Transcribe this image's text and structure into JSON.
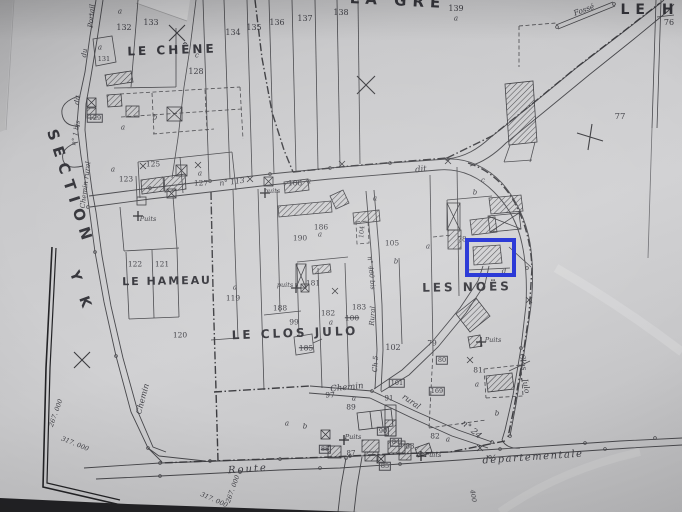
{
  "colors": {
    "ink": "#47474b",
    "paper": "#c9c9cb",
    "highlight_blue": "#1b2bd4",
    "sheet_edge_black": "#232326"
  },
  "highlight": {
    "name": "highlighted-parcel-box",
    "x": 465,
    "y": 238,
    "w": 43,
    "h": 31,
    "border": 4,
    "color": "#1b2bd4"
  },
  "labels": [
    {
      "t": "LA   GRE",
      "x": 398,
      "y": 1,
      "r": 3,
      "fs": 15,
      "b": 1,
      "ls": 6,
      "name": "place-name-la-gre"
    },
    {
      "t": "LE  H",
      "x": 650,
      "y": 10,
      "r": 0,
      "fs": 14,
      "b": 1,
      "ls": 6,
      "name": "place-name-le-h"
    },
    {
      "t": "LE CHÊNE",
      "x": 172,
      "y": 50,
      "r": -2,
      "fs": 12,
      "b": 1,
      "ls": 3,
      "name": "place-name-le-chene"
    },
    {
      "t": "LE HAMEAU",
      "x": 167,
      "y": 281,
      "r": -1,
      "fs": 11,
      "b": 1,
      "ls": 2,
      "name": "place-name-le-hameau"
    },
    {
      "t": "LE CLOS JULO",
      "x": 295,
      "y": 333,
      "r": -2,
      "fs": 12,
      "b": 1,
      "ls": 3,
      "name": "place-name-le-clos-julo"
    },
    {
      "t": "LES NOËS",
      "x": 467,
      "y": 287,
      "r": -1,
      "fs": 12,
      "b": 1,
      "ls": 3,
      "name": "place-name-les-noes"
    },
    {
      "t": "SECTION",
      "x": 70,
      "y": 188,
      "r": 72,
      "fs": 15,
      "b": 1,
      "ls": 7,
      "name": "section-label"
    },
    {
      "t": "Y K",
      "x": 81,
      "y": 292,
      "r": 70,
      "fs": 14,
      "b": 1,
      "ls": 6,
      "name": "section-code"
    },
    {
      "t": "Portail",
      "x": 92,
      "y": 16,
      "r": -85,
      "fs": 7,
      "i": 1,
      "name": "road-name"
    },
    {
      "t": "du",
      "x": 85,
      "y": 53,
      "r": -83,
      "fs": 7,
      "i": 1,
      "name": "road-name"
    },
    {
      "t": "dit",
      "x": 78,
      "y": 100,
      "r": -80,
      "fs": 7,
      "i": 1,
      "name": "road-name"
    },
    {
      "t": "n° 1 bis",
      "x": 76,
      "y": 133,
      "r": -80,
      "fs": 6.5,
      "i": 1,
      "name": "road-name"
    },
    {
      "t": "Chemin rural",
      "x": 86,
      "y": 185,
      "r": -83,
      "fs": 7,
      "i": 1,
      "name": "road-name"
    },
    {
      "t": "n° 113",
      "x": 232,
      "y": 182,
      "r": -7,
      "fs": 7.5,
      "i": 1,
      "name": "road-name"
    },
    {
      "t": "dit",
      "x": 421,
      "y": 170,
      "r": -6,
      "fs": 8.5,
      "i": 1,
      "name": "road-name"
    },
    {
      "t": "Chemin",
      "x": 143,
      "y": 399,
      "r": -75,
      "fs": 8,
      "i": 1,
      "name": "road-name"
    },
    {
      "t": "Route",
      "x": 248,
      "y": 470,
      "r": -4,
      "fs": 10,
      "i": 1,
      "ls": 2,
      "name": "road-name-route"
    },
    {
      "t": "départementale",
      "x": 533,
      "y": 458,
      "r": -4,
      "fs": 10,
      "i": 1,
      "ls": 1.5,
      "name": "road-name-departementale"
    },
    {
      "t": "Chemin",
      "x": 347,
      "y": 388,
      "r": -6,
      "fs": 8.5,
      "i": 1,
      "name": "road-name"
    },
    {
      "t": "rural",
      "x": 411,
      "y": 402,
      "r": 35,
      "fs": 8,
      "i": 1,
      "name": "road-name"
    },
    {
      "t": "n° 24",
      "x": 471,
      "y": 430,
      "r": 40,
      "fs": 8.5,
      "i": 1,
      "name": "road-name"
    },
    {
      "t": "n° 460 bis",
      "x": 371,
      "y": 273,
      "r": 84,
      "fs": 6.5,
      "i": 1,
      "name": "road-name"
    },
    {
      "t": "Rural",
      "x": 373,
      "y": 316,
      "r": -86,
      "fs": 7,
      "i": 1,
      "name": "road-name"
    },
    {
      "t": "Ch 5",
      "x": 376,
      "y": 364,
      "r": -86,
      "fs": 7,
      "i": 1,
      "name": "road-name"
    },
    {
      "t": "Clos",
      "x": 523,
      "y": 362,
      "r": 80,
      "fs": 7.5,
      "i": 1,
      "name": "road-name-clos-julo"
    },
    {
      "t": "Julo",
      "x": 526,
      "y": 386,
      "r": 80,
      "fs": 7.5,
      "i": 1,
      "name": "road-name-clos-julo"
    },
    {
      "t": "Fossé",
      "x": 584,
      "y": 10,
      "r": -20,
      "fs": 7.5,
      "i": 1,
      "name": "fosse-label"
    },
    {
      "t": "Puits",
      "x": 148,
      "y": 219,
      "fs": 6.5,
      "i": 1,
      "name": "well-label"
    },
    {
      "t": "puits",
      "x": 272,
      "y": 191,
      "fs": 6.5,
      "i": 1,
      "name": "well-label"
    },
    {
      "t": "puits",
      "x": 285,
      "y": 285,
      "fs": 6.5,
      "i": 1,
      "name": "well-label"
    },
    {
      "t": "Puits",
      "x": 493,
      "y": 340,
      "fs": 6.5,
      "i": 1,
      "name": "well-label"
    },
    {
      "t": "Puits",
      "x": 353,
      "y": 437,
      "fs": 6.5,
      "i": 1,
      "name": "well-label"
    },
    {
      "t": "Puits",
      "x": 433,
      "y": 455,
      "fs": 6.5,
      "i": 1,
      "name": "well-label"
    },
    {
      "t": "267. 000",
      "x": 56,
      "y": 413,
      "r": -70,
      "fs": 6.5,
      "i": 1,
      "name": "grid-coordinate"
    },
    {
      "t": "317. 000",
      "x": 75,
      "y": 444,
      "r": 22,
      "fs": 6.5,
      "i": 1,
      "name": "grid-coordinate"
    },
    {
      "t": "317. 000",
      "x": 214,
      "y": 500,
      "r": 24,
      "fs": 6.5,
      "i": 1,
      "name": "grid-coordinate"
    },
    {
      "t": "267. 000",
      "x": 233,
      "y": 489,
      "r": -70,
      "fs": 6.5,
      "i": 1,
      "name": "grid-coordinate"
    },
    {
      "t": "400",
      "x": 473,
      "y": 496,
      "r": 80,
      "fs": 6.5,
      "i": 1,
      "name": "grid-coordinate"
    },
    {
      "t": "a",
      "x": 120,
      "y": 12,
      "fs": 7,
      "i": 1
    },
    {
      "t": "132",
      "x": 124,
      "y": 28,
      "fs": 8
    },
    {
      "t": "133",
      "x": 151,
      "y": 23,
      "fs": 8
    },
    {
      "t": "134",
      "x": 233,
      "y": 33,
      "fs": 8
    },
    {
      "t": "135",
      "x": 254,
      "y": 28,
      "fs": 8
    },
    {
      "t": "136",
      "x": 277,
      "y": 23,
      "fs": 8
    },
    {
      "t": "137",
      "x": 305,
      "y": 19,
      "fs": 8
    },
    {
      "t": "138",
      "x": 341,
      "y": 13,
      "fs": 8
    },
    {
      "t": "139",
      "x": 456,
      "y": 9,
      "fs": 8
    },
    {
      "t": "a",
      "x": 456,
      "y": 19,
      "fs": 7,
      "i": 1
    },
    {
      "t": "76",
      "x": 669,
      "y": 23,
      "fs": 8
    },
    {
      "t": "77",
      "x": 620,
      "y": 117,
      "fs": 8.5
    },
    {
      "t": "a",
      "x": 100,
      "y": 48,
      "fs": 7,
      "i": 1
    },
    {
      "t": "131",
      "x": 104,
      "y": 59,
      "fs": 6.5
    },
    {
      "t": "c",
      "x": 197,
      "y": 56,
      "fs": 7,
      "i": 1
    },
    {
      "t": "128",
      "x": 196,
      "y": 72,
      "fs": 8
    },
    {
      "t": "b",
      "x": 155,
      "y": 118,
      "fs": 7,
      "i": 1
    },
    {
      "t": "a",
      "x": 123,
      "y": 128,
      "fs": 7,
      "i": 1
    },
    {
      "t": "129",
      "x": 95,
      "y": 118,
      "fs": 6.5,
      "box": 1
    },
    {
      "t": "125",
      "x": 153,
      "y": 164,
      "fs": 7.5
    },
    {
      "t": "a",
      "x": 113,
      "y": 170,
      "fs": 7,
      "i": 1
    },
    {
      "t": "123",
      "x": 126,
      "y": 179,
      "fs": 7.5
    },
    {
      "t": "a",
      "x": 200,
      "y": 174,
      "fs": 7,
      "i": 1
    },
    {
      "t": "127",
      "x": 201,
      "y": 183,
      "fs": 7.5
    },
    {
      "t": "122",
      "x": 135,
      "y": 264,
      "fs": 7.5
    },
    {
      "t": "121",
      "x": 162,
      "y": 264,
      "fs": 7.5
    },
    {
      "t": "120",
      "x": 180,
      "y": 335,
      "fs": 7.5
    },
    {
      "t": "a",
      "x": 235,
      "y": 288,
      "fs": 7,
      "i": 1
    },
    {
      "t": "119",
      "x": 233,
      "y": 298,
      "fs": 7.5
    },
    {
      "t": "106",
      "x": 295,
      "y": 183,
      "fs": 7.5
    },
    {
      "t": "a",
      "x": 309,
      "y": 182,
      "fs": 7,
      "i": 1
    },
    {
      "t": "a",
      "x": 375,
      "y": 199,
      "fs": 7,
      "i": 1
    },
    {
      "t": "186",
      "x": 321,
      "y": 227,
      "fs": 7.5
    },
    {
      "t": "a",
      "x": 320,
      "y": 235,
      "fs": 7,
      "i": 1
    },
    {
      "t": "190",
      "x": 300,
      "y": 238,
      "fs": 7.5
    },
    {
      "t": "104",
      "x": 362,
      "y": 232,
      "r": -84,
      "fs": 6.5
    },
    {
      "t": "105",
      "x": 392,
      "y": 243,
      "fs": 7.5
    },
    {
      "t": "b",
      "x": 396,
      "y": 262,
      "fs": 7,
      "i": 1
    },
    {
      "t": "188",
      "x": 280,
      "y": 308,
      "fs": 7.5
    },
    {
      "t": "99",
      "x": 294,
      "y": 322,
      "fs": 7.5
    },
    {
      "t": "181",
      "x": 313,
      "y": 283,
      "fs": 7.5
    },
    {
      "t": "182",
      "x": 328,
      "y": 313,
      "fs": 7.5
    },
    {
      "t": "a",
      "x": 331,
      "y": 323,
      "fs": 7,
      "i": 1
    },
    {
      "t": "183",
      "x": 359,
      "y": 307,
      "fs": 7.5
    },
    {
      "t": "100",
      "x": 352,
      "y": 318,
      "fs": 7.5,
      "strike": 1
    },
    {
      "t": "185",
      "x": 306,
      "y": 348,
      "fs": 7.5,
      "strike": 1
    },
    {
      "t": "102",
      "x": 393,
      "y": 348,
      "fs": 8
    },
    {
      "t": "101",
      "x": 397,
      "y": 383,
      "fs": 6.5,
      "box": 1
    },
    {
      "t": "169",
      "x": 437,
      "y": 391,
      "fs": 6.5,
      "box": 1
    },
    {
      "t": "97",
      "x": 330,
      "y": 395,
      "fs": 7.5
    },
    {
      "t": "a",
      "x": 354,
      "y": 399,
      "fs": 7,
      "i": 1
    },
    {
      "t": "89",
      "x": 351,
      "y": 407,
      "fs": 7.5
    },
    {
      "t": "91",
      "x": 389,
      "y": 399,
      "fs": 7
    },
    {
      "t": "90",
      "x": 383,
      "y": 431,
      "fs": 6.5,
      "box": 1
    },
    {
      "t": "88",
      "x": 325,
      "y": 449,
      "fs": 6.5,
      "box": 1,
      "strike": 1
    },
    {
      "t": "87",
      "x": 351,
      "y": 454,
      "fs": 7
    },
    {
      "t": "84",
      "x": 396,
      "y": 442,
      "fs": 6.5,
      "box": 1
    },
    {
      "t": "83",
      "x": 410,
      "y": 447,
      "fs": 7
    },
    {
      "t": "85",
      "x": 385,
      "y": 466,
      "fs": 6.5,
      "box": 1
    },
    {
      "t": "82",
      "x": 435,
      "y": 436,
      "fs": 7.5
    },
    {
      "t": "a",
      "x": 448,
      "y": 440,
      "fs": 7,
      "i": 1
    },
    {
      "t": "a",
      "x": 287,
      "y": 424,
      "fs": 7,
      "i": 1
    },
    {
      "t": "b",
      "x": 305,
      "y": 427,
      "fs": 7,
      "i": 1
    },
    {
      "t": "78",
      "x": 462,
      "y": 240,
      "fs": 7,
      "name": "highlighted-parcel-number"
    },
    {
      "t": "a",
      "x": 428,
      "y": 247,
      "fs": 7,
      "i": 1
    },
    {
      "t": "c",
      "x": 483,
      "y": 181,
      "fs": 7,
      "i": 1
    },
    {
      "t": "b",
      "x": 475,
      "y": 193,
      "fs": 7,
      "i": 1
    },
    {
      "t": "d",
      "x": 504,
      "y": 272,
      "fs": 7,
      "i": 1
    },
    {
      "t": "b",
      "x": 497,
      "y": 414,
      "fs": 7,
      "i": 1
    },
    {
      "t": "79",
      "x": 432,
      "y": 343,
      "fs": 7.5
    },
    {
      "t": "80",
      "x": 442,
      "y": 360,
      "fs": 6.5,
      "box": 1
    },
    {
      "t": "81",
      "x": 478,
      "y": 370,
      "fs": 7.5
    },
    {
      "t": "a",
      "x": 477,
      "y": 385,
      "fs": 7,
      "i": 1
    }
  ]
}
